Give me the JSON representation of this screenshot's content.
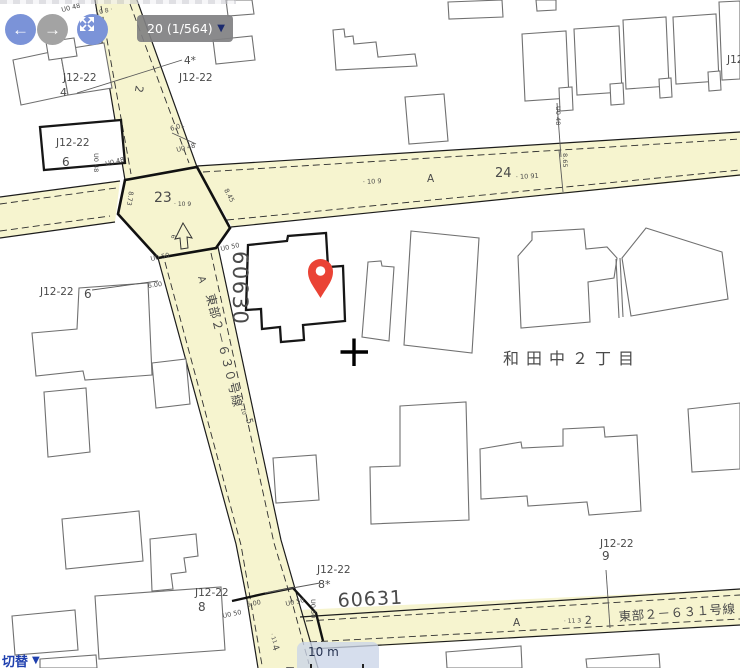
{
  "toolbar": {
    "back_label": "←",
    "forward_label": "→",
    "page_indicator": "20 (1/564)",
    "dropdown_arrow": "▼"
  },
  "footer": {
    "switch_label": "切替",
    "switch_arrow": "▼",
    "scale_label": "10 m"
  },
  "colors": {
    "road_fill": "#f6f4cf",
    "pin_red": "#ea4335",
    "button_blue": "#7b93d8",
    "button_gray": "#a3a3a3",
    "chip_bg": "#808082",
    "link_blue": "#1e3fae",
    "gray_map_text": "#9a9a9a"
  },
  "map": {
    "area_name": "和田中２丁目",
    "plats": {
      "p60630": "60630",
      "p60631": "60631"
    },
    "roads": {
      "r630": "東部２－６３０号線",
      "r631": "東部２－６３１号線"
    },
    "parcels": {
      "tl": {
        "header": "J12-22",
        "num": "4"
      },
      "tl2": {
        "header": "J12-22",
        "num": "4*"
      },
      "box6": {
        "header": "J12-22",
        "num": "6"
      },
      "mid6": {
        "header": "J12-22",
        "num": "6"
      },
      "b8": {
        "header": "J12-22",
        "num": "8"
      },
      "b8s": {
        "header": "J12-22",
        "num": "8*"
      },
      "br9": {
        "header": "J12-22",
        "num": "9"
      },
      "tr": {
        "header": "J12-22"
      }
    },
    "road_marks": {
      "a": "A",
      "n23": "23",
      "n24": "24",
      "n2": "2",
      "n5": "5",
      "n4": "4"
    },
    "chainage": {
      "c109": "· 10 9",
      "c1091": "· 10 91",
      "c108": "10 8 ·",
      "c10": "· 10",
      "c11": "· 11",
      "c113": "· 11 3"
    },
    "measures": {
      "m865": "8.65",
      "m873": "8.73",
      "m845": "8.45",
      "m601": "6.01",
      "m600": "6.00",
      "m6": "6",
      "u048": "U0 48",
      "u050": "U0 50"
    }
  }
}
